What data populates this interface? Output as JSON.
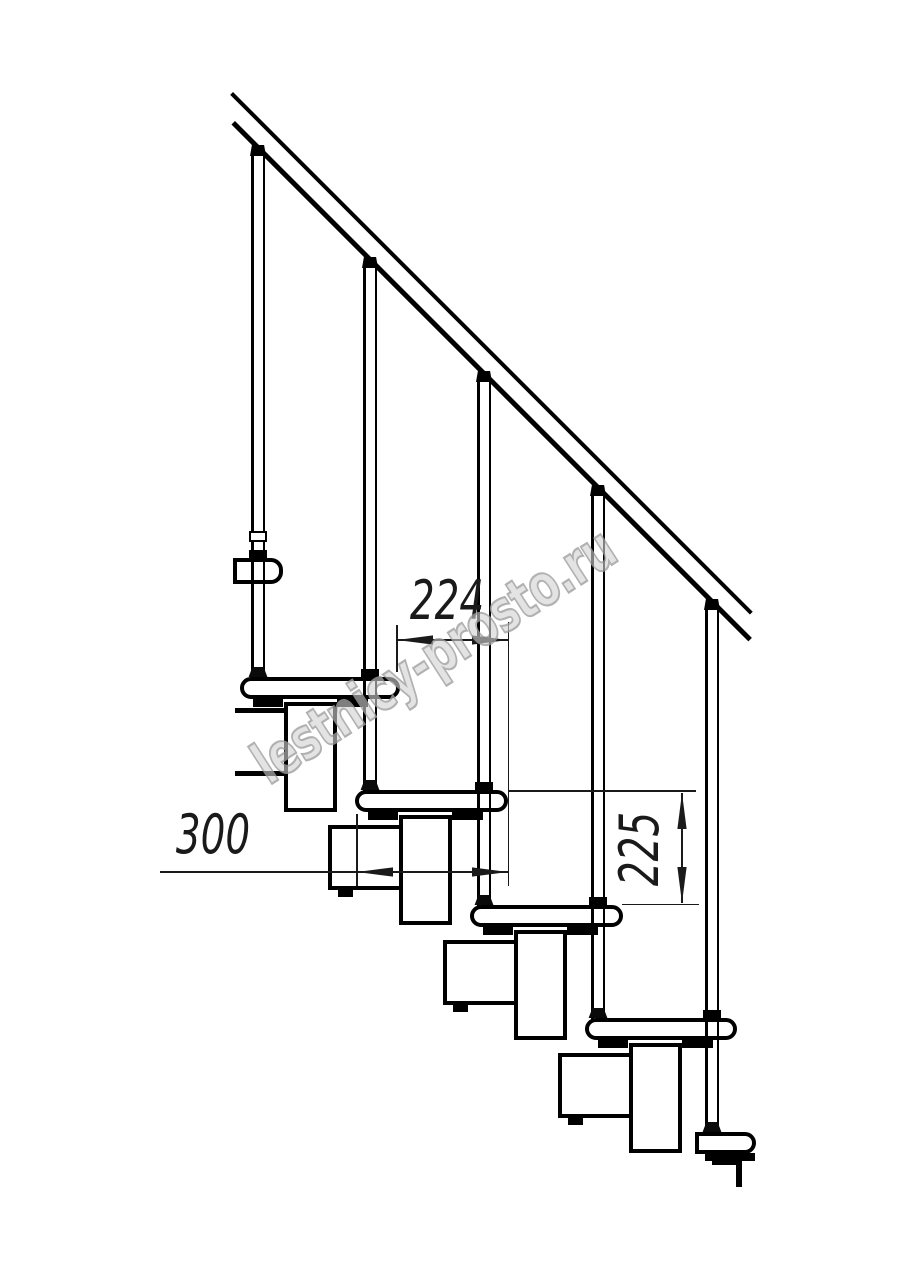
{
  "drawing": {
    "dimensions": {
      "going_label": "224",
      "tread_length_label": "300",
      "rise_label": "225"
    },
    "watermark": {
      "text": "lestnicy-prosto.ru"
    },
    "colors": {
      "line": "#000000",
      "dimension": "#1a1a1a",
      "watermark_stroke": "#9e9e9e",
      "background": "#ffffff"
    }
  }
}
